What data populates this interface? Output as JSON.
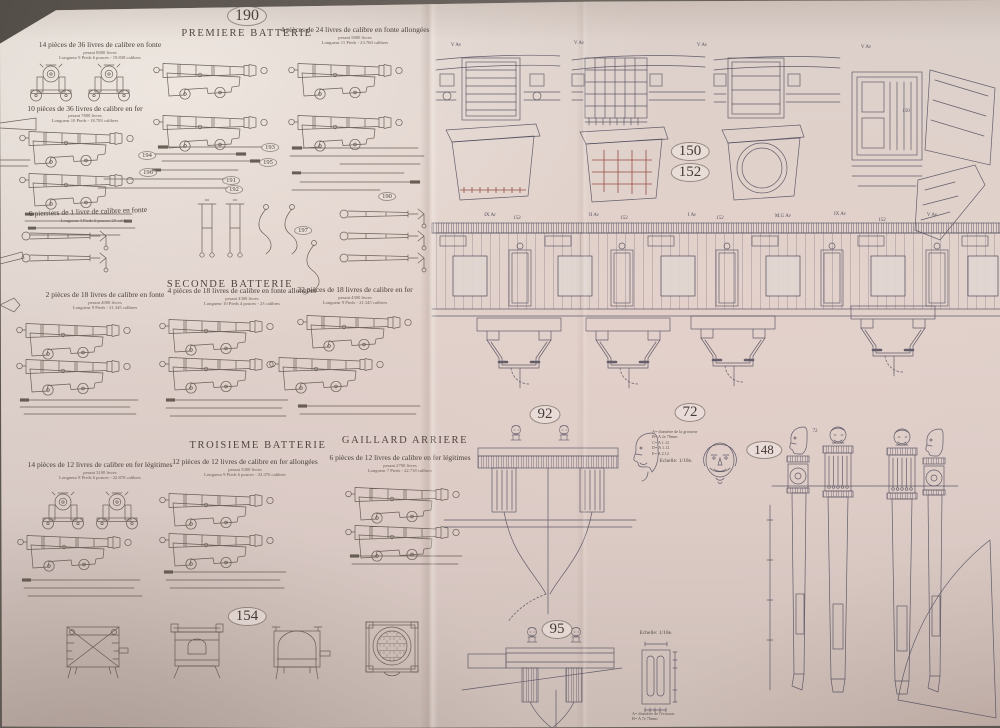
{
  "plate": {
    "number": "190",
    "title": "PREMIERE BATTERIE"
  },
  "premiere": {
    "g36_fonte": {
      "label": "14 pièces de 36 livres de calibre en fonte",
      "sub1": "pesant 8000 livres",
      "sub2": "Longueur 9 Pieds 6 pouces - 19.838 calibres"
    },
    "g24_fonte": {
      "label": "4 pièces de 24 livres de calibre en fonte allongées",
      "sub1": "pesant 5800 livres",
      "sub2": "Longueur 11 Pieds - 23.760 calibres"
    },
    "g36_fer": {
      "label": "10 pièces de 36 livres de calibre en fer",
      "sub1": "pesant 7800 livres",
      "sub2": "Longueur 10 Pieds - 18.783 calibres"
    },
    "pierriers": {
      "label": "6 pierriers de 1 livre de calibre en fonte",
      "sub1": "Longueur 4 Pieds 6 pouces 29 calibres"
    },
    "refs": {
      "r191": "191",
      "r192": "192",
      "r193": "193",
      "r194": "194",
      "r195": "195",
      "r196": "196",
      "r197": "197",
      "r190": "190"
    }
  },
  "seconde": {
    "title": "SECONDE BATTERIE",
    "g18_fonte": {
      "label": "2 pièces de 18 livres de calibre en fonte",
      "sub1": "pesant 4000 livres",
      "sub2": "Longueur 9 Pieds - 21.345 calibres"
    },
    "g18_allongees": {
      "label": "4 pièces de 18 livres de calibre en fonte allongées",
      "sub1": "pesant 4300 livres",
      "sub2": "Longueur 10 Pieds 4 pouces - 23 calibres"
    },
    "g18_fer": {
      "label": "22 pièces de 18 livres de calibre en fer",
      "sub1": "pesant 4300 livres",
      "sub2": "Longueur 9 Pieds - 21.345 calibres"
    }
  },
  "troisieme": {
    "title": "TROISIEME BATTERIE",
    "g12_legitimes": {
      "label": "14 pièces de 12 livres de calibre en fer légitimes",
      "sub1": "pesant 3100 livres",
      "sub2": "Longueur 8 Pieds 6 pouces - 22.878 calibres"
    },
    "g12_allongees": {
      "label": "12 pièces de 12 livres de calibre en fer allongées",
      "sub1": "pesant 3300 livres",
      "sub2": "Longueur 9 Pieds 6 pouces - 23.376 calibres"
    }
  },
  "gaillard": {
    "title": "GAILLARD ARRIERE",
    "g12_legitimes": {
      "label": "6 pièces de 12 livres de calibre en fer légitimes",
      "sub1": "pesant 2700 livres",
      "sub2": "Longueur 7 Pieds - 22.718 calibres"
    }
  },
  "galley": {
    "ref": "154"
  },
  "ports": {
    "top_labels": [
      "V Av",
      "V Av",
      "V Av",
      "V Av"
    ],
    "ref150": "150",
    "ref152": "152",
    "ref150_small": "150",
    "stations": [
      {
        "name": "IX Ar",
        "num": "152"
      },
      {
        "name": "II Av",
        "num": "152"
      },
      {
        "name": "I Av",
        "num": "152"
      },
      {
        "name": "M.G Av",
        "num": ""
      },
      {
        "name": "IX Av",
        "num": "152"
      },
      {
        "name": "V Av",
        "num": ""
      }
    ]
  },
  "sculpture": {
    "ref92": "92",
    "ref72": "72",
    "ref72_small": "72",
    "ref148": "148",
    "ref95": "95",
    "echelle_72": "Echelle: 1/18e.",
    "echelle_95": "Echelle: 1/18e.",
    "notes72": [
      "A= diamètre de la grosseur",
      "B= A 2e 76mm",
      "C= A 1.12",
      "D= A 1.12",
      "E= A 2.12"
    ],
    "notes95": [
      "A= diamètre de l'écusson",
      "B= A 7e 76mm"
    ]
  }
}
